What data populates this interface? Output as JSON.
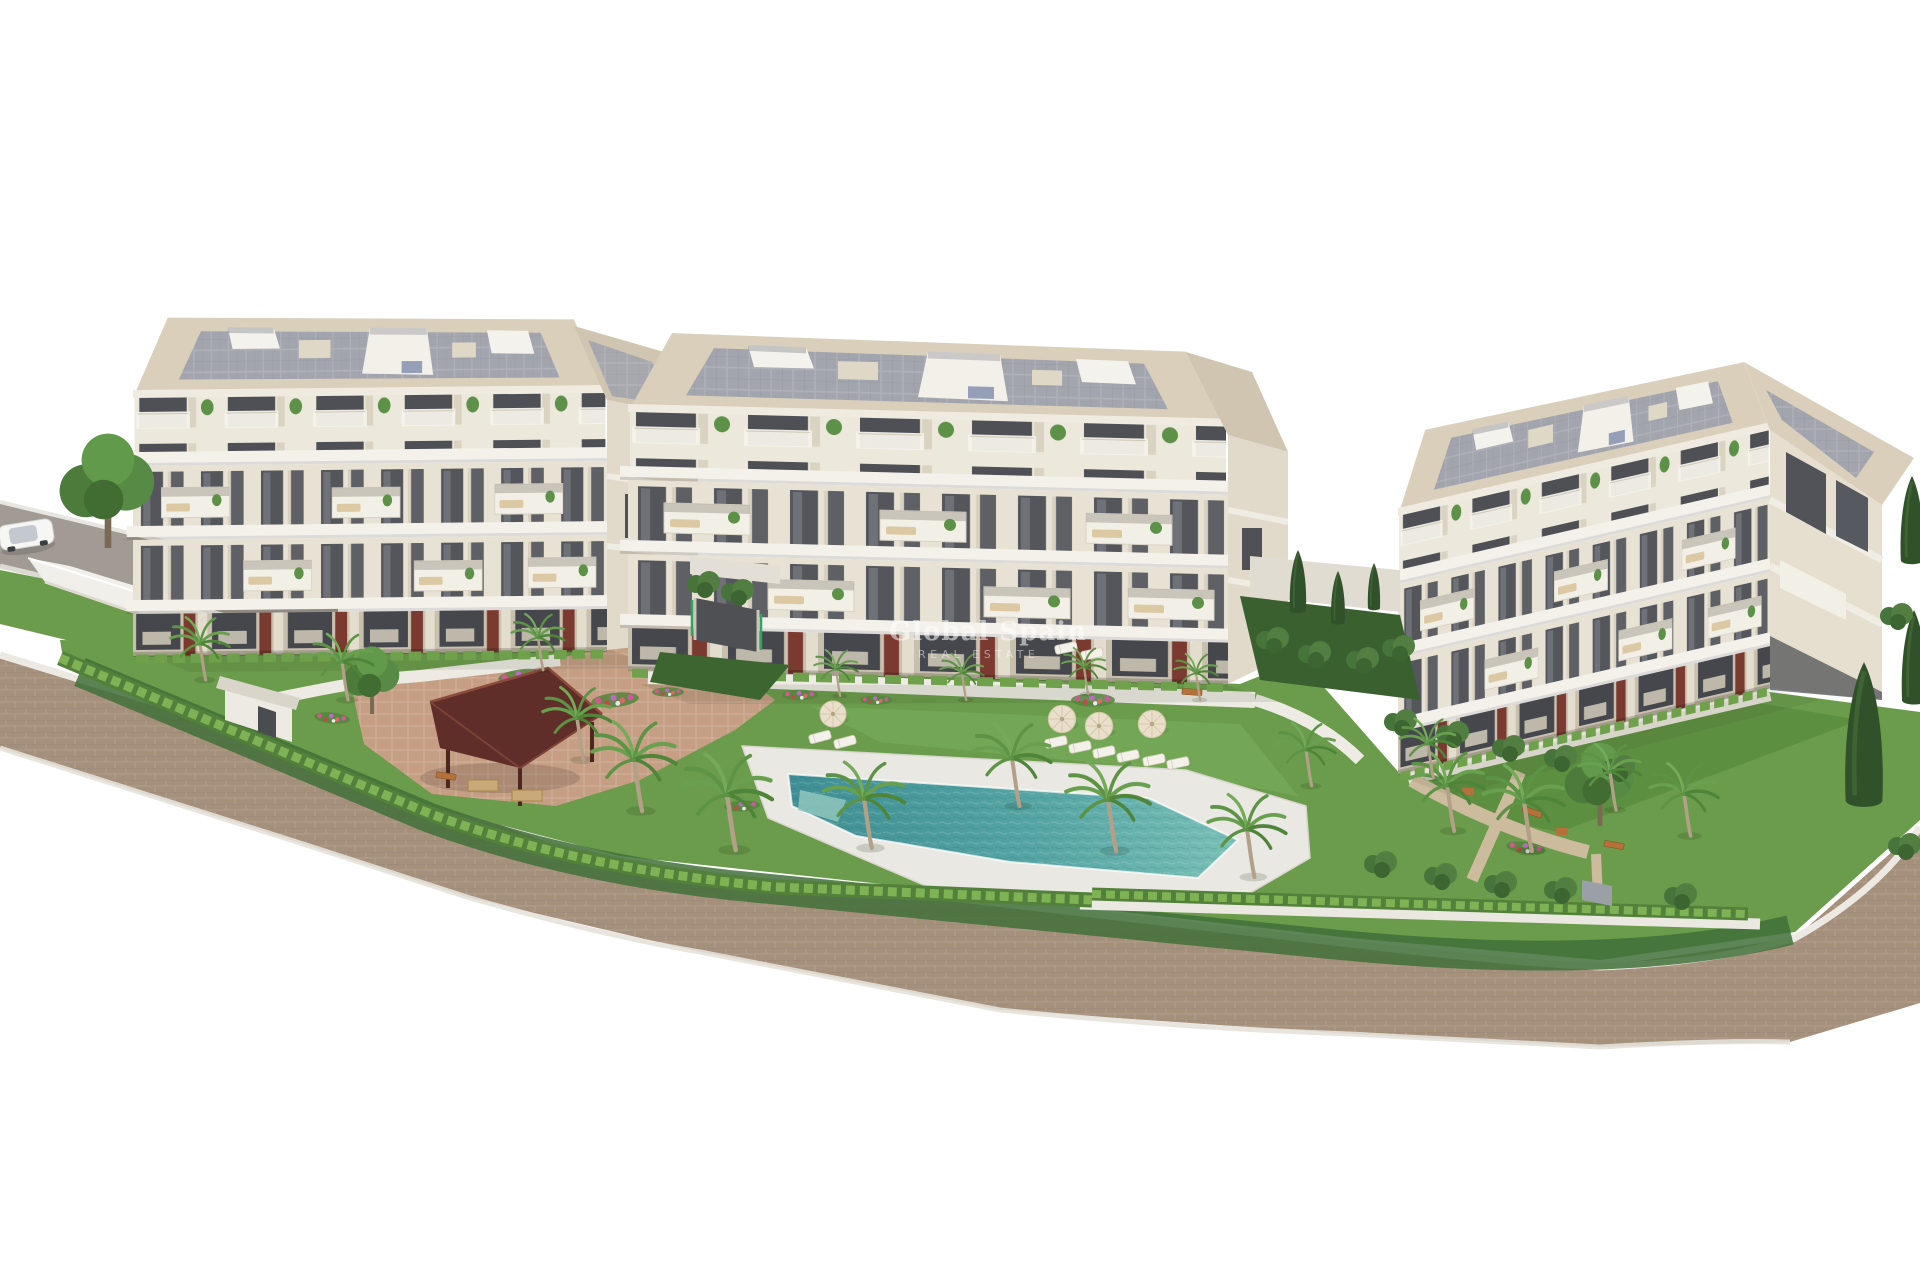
{
  "scene": {
    "type": "3D architectural rendering",
    "setting": "Aerial view of a new-build residential complex rendered on a plain white background",
    "watermark": {
      "line1": "Global Spain",
      "line2": "REAL ESTATE"
    },
    "buildings": [
      {
        "id": "left",
        "floors": 4,
        "roof": "flat roof with grey panel decking and white courtyard cut-outs",
        "facade": "cream walls, dark glazing, white balconies, maroon ground-floor accents"
      },
      {
        "id": "middle",
        "floors": 4,
        "roof": "flat roof with grey panel decking and white courtyard cut-outs",
        "facade": "cream walls, dark glazing, white balconies, maroon ground-floor accents"
      },
      {
        "id": "right",
        "floors": 4,
        "roof": "flat roof with grey panel decking",
        "facade": "angled toward the road with its end facade visible at the right edge"
      }
    ],
    "landscape": {
      "pool": "free-form turquoise swimming pool with white sun deck",
      "gazebo": "dark red hip-roof timber pavilion with picnic tables",
      "palm_trees": "many palms around the pool and gardens",
      "hedges": "trimmed perimeter hedgerows along the roads",
      "lawns": "landscaped lawns with flower beds, benches and gravel paths",
      "parasol_count": 4,
      "sun_loungers": "white loungers beside the pool"
    },
    "roads": {
      "upper_left": "grey asphalt road with a white car",
      "perimeter": "brown paved road curving around the lower boundary"
    },
    "vehicle": {
      "type": "car",
      "color": "white"
    },
    "structures": {
      "parking_ramp": "underground parking entrance between the left and middle buildings",
      "entrance_gate": "white pedestrian gate house on the lower-left boundary"
    }
  },
  "palette": {
    "background": "#ffffff",
    "facade": "#e8e2d4",
    "roof_frame": "#d9cfbb",
    "roof_panel": "#a3a5ae",
    "window": "#54565c",
    "accent_maroon": "#7b3a30",
    "grass": "#6b9c4b",
    "grass_dark": "#41703a",
    "hedge": "#7fb254",
    "pool": "#79bfb6",
    "pool_deep": "#3e8e93",
    "road_brick": "#a5907c",
    "road_asphalt": "#a19b94",
    "path_white": "#e9e8e2",
    "path_terracotta": "#c59e83",
    "gazebo_roof": "#5f2e28",
    "wood": "#b5713a"
  }
}
